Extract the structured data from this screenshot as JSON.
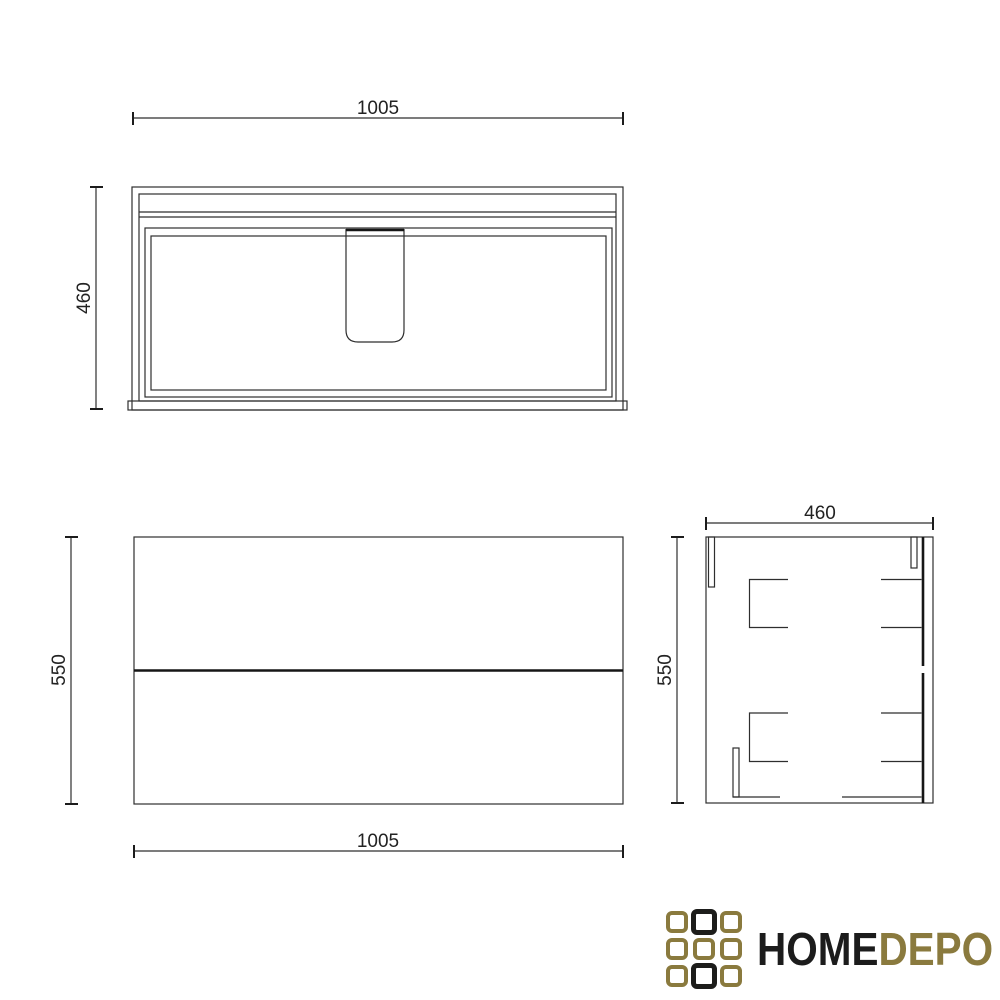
{
  "page": {
    "background": "#ffffff",
    "line_color": "#2e2e2e",
    "description_labels": {
      "drawing_type": "cabinet-three-view-technical-drawing"
    }
  },
  "views": {
    "top": {
      "width_label": "1005",
      "depth_label": "460"
    },
    "front": {
      "width_label": "1005",
      "height_label": "550"
    },
    "side": {
      "depth_label": "460",
      "height_label": "550"
    }
  },
  "logo": {
    "word_primary": "HOME",
    "word_secondary": "DEPO",
    "color_gold": "#8a7a3e",
    "color_black": "#1d1d1b",
    "grid_pattern": [
      [
        "gold",
        "black",
        "gold"
      ],
      [
        "gold",
        "gold",
        "gold"
      ],
      [
        "gold",
        "black",
        "gold"
      ]
    ]
  }
}
